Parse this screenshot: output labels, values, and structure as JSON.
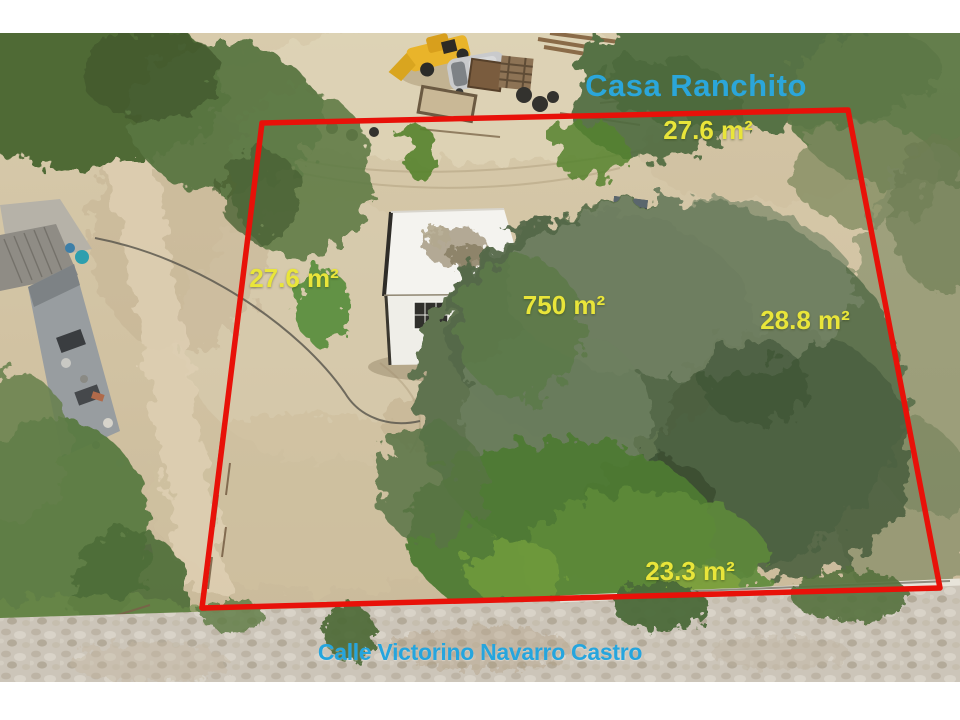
{
  "photo": {
    "type": "aerial-drone-photo-of-property-lot",
    "property_title": "Casa Ranchito",
    "street_name": "Calle Victorino Navarro Castro",
    "total_area_label": "750 m²",
    "side_measurements": {
      "top": "27.6 m²",
      "left": "27.6 m²",
      "right": "28.8 m²",
      "bottom": "23.3 m²"
    },
    "colors": {
      "boundary_line": "#e81109",
      "measurement_text": "#e9e53a",
      "title_text": "#2ba6da",
      "street_text": "#25a5de"
    }
  }
}
